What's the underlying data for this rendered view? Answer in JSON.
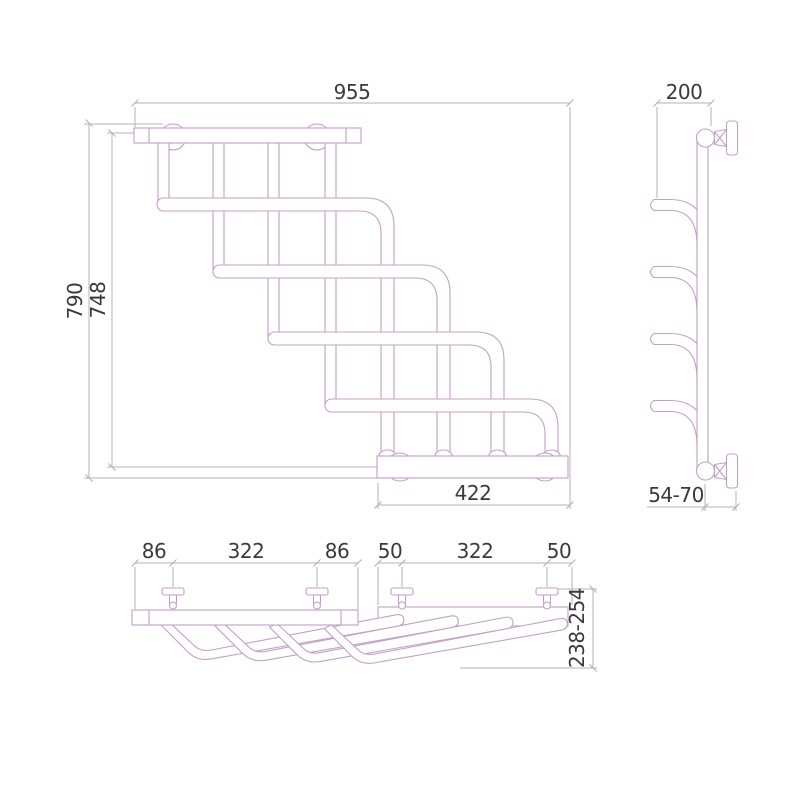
{
  "drawing": {
    "title": "Cascade towel rail — dimensional drawing, three orthographic views",
    "colors": {
      "outline": "#c49fc6",
      "dimension_line": "#b3b3b3",
      "text": "#3a3a3a",
      "background": "#ffffff"
    },
    "views": {
      "front": {
        "name": "front view",
        "dims": {
          "width_total": "955",
          "height_total": "790",
          "height_mount": "748",
          "bracket_width": "422"
        }
      },
      "side": {
        "name": "side view",
        "dims": {
          "depth": "200",
          "wall_offset": "54-70"
        }
      },
      "top": {
        "name": "top view",
        "dims": {
          "left_end": "86",
          "left_span": "322",
          "left_end2": "86",
          "right_end": "50",
          "right_span": "322",
          "right_end2": "50",
          "depth_range": "238-254"
        }
      }
    }
  }
}
